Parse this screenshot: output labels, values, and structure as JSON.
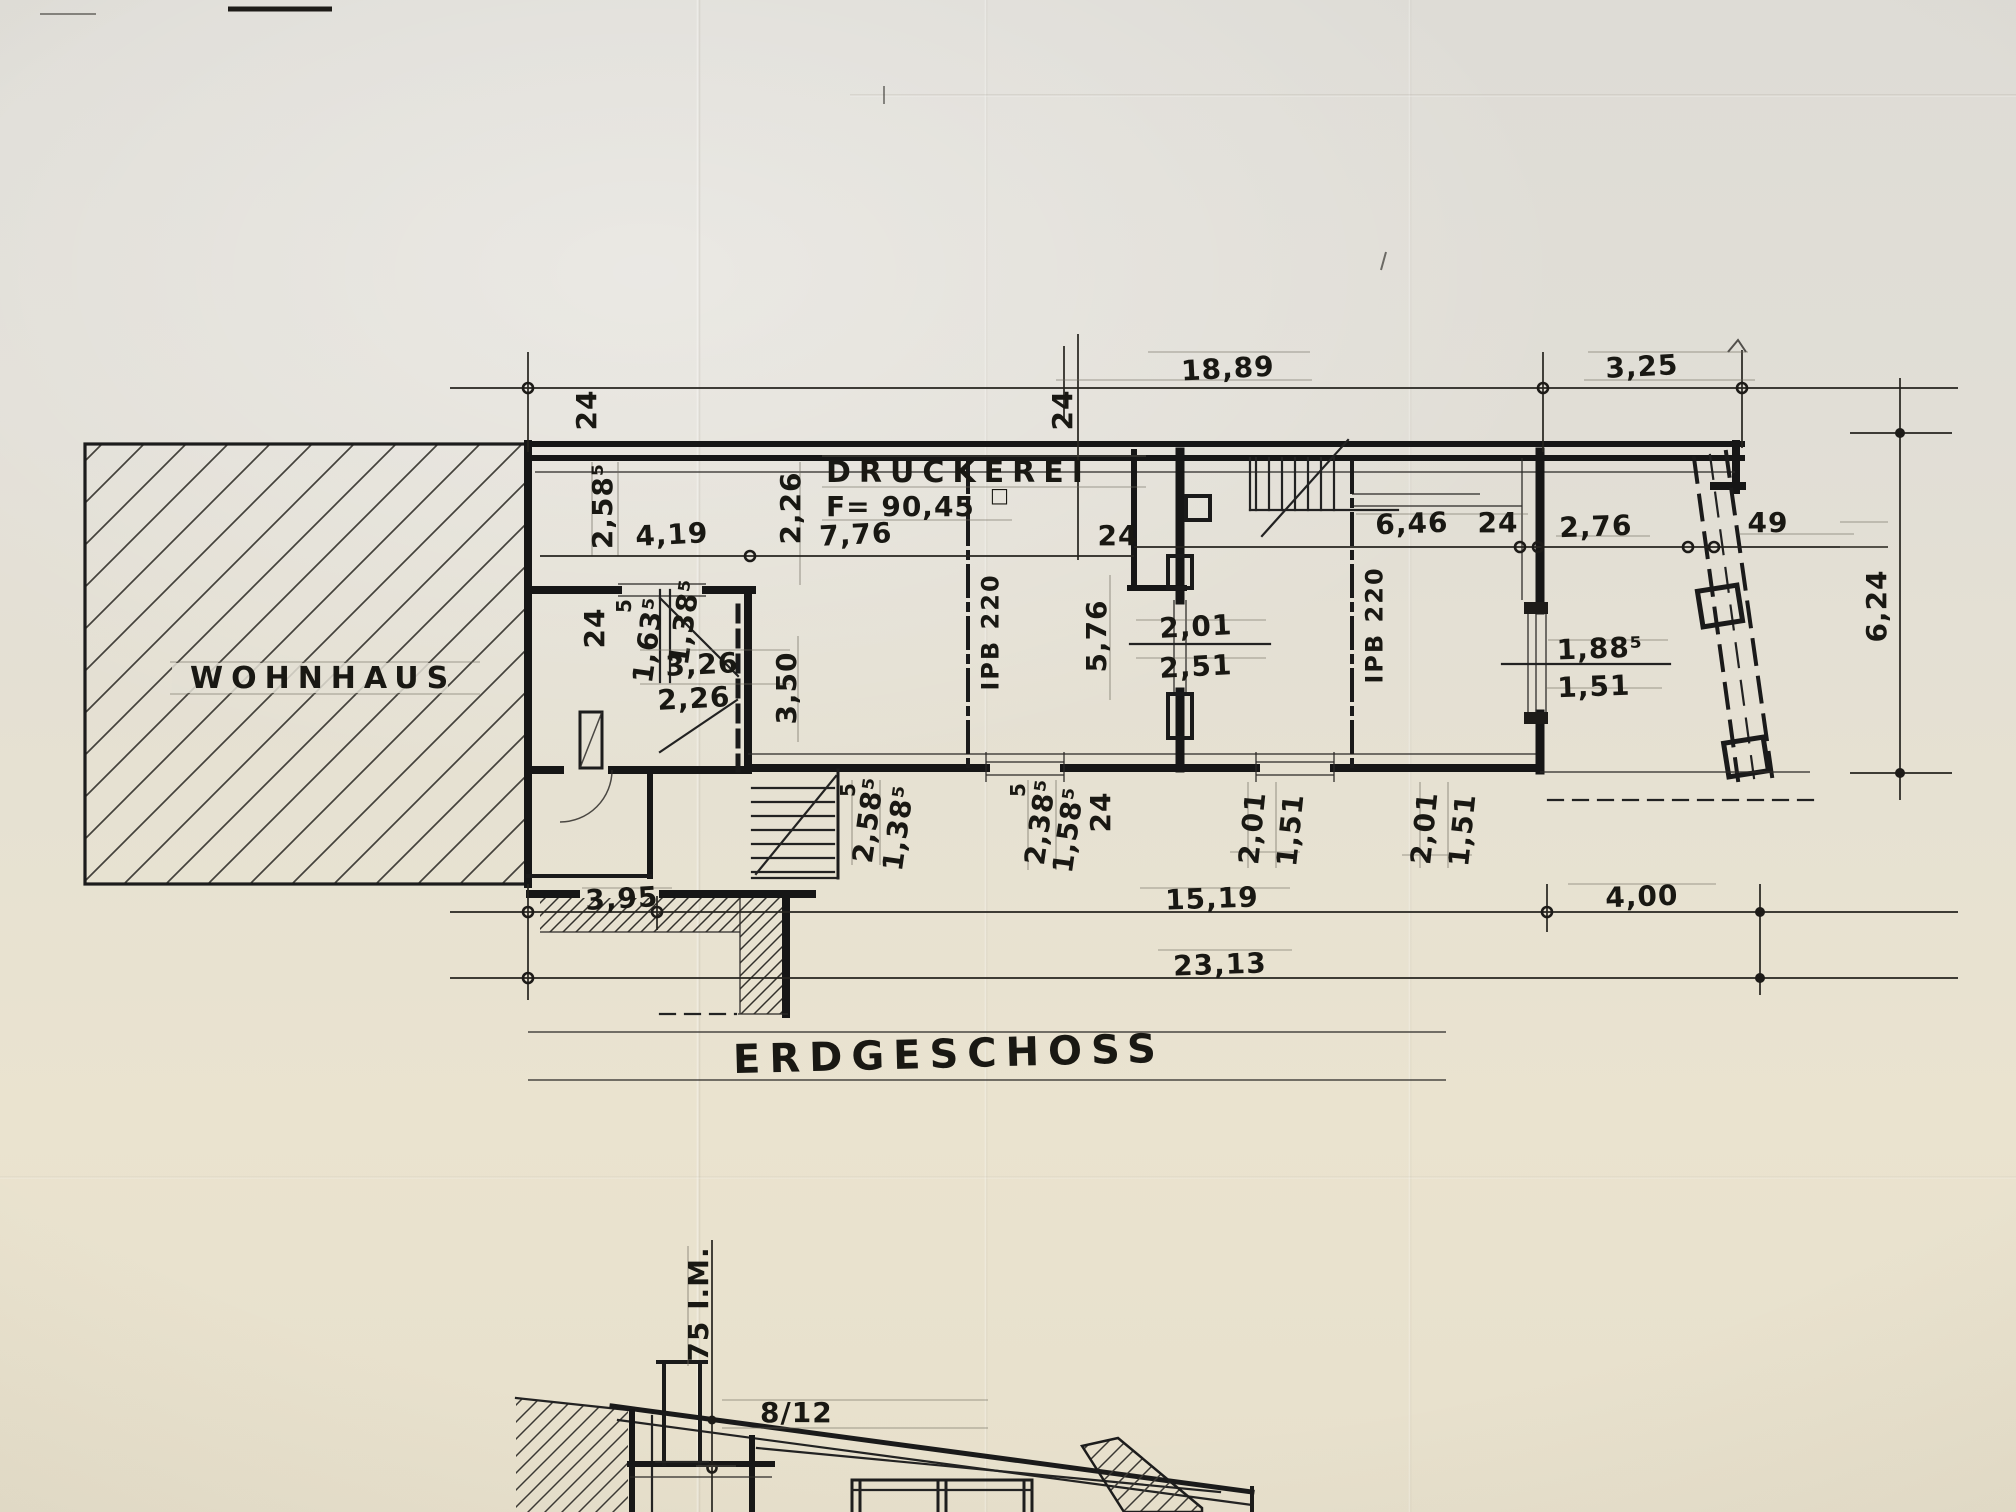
{
  "colors": {
    "paper": "#e6e1d3",
    "ink": "#1b1b1b"
  },
  "titles": {
    "sheet": "ERDGESCHOSS"
  },
  "rooms": {
    "wohnhaus": "WOHNHAUS",
    "druckerei": "DRUCKEREI",
    "druckerei_area": "F= 90,45",
    "druckerei_area_unit": "□"
  },
  "beams": {
    "left": "IPB 220",
    "right": "IPB 220"
  },
  "dims": {
    "top_main": "18,89",
    "top_right": "3,25",
    "top_wall": "24",
    "left_wall": "24",
    "left_height": "2,58⁵",
    "room1_width": "4,19",
    "room1_height": "2,26",
    "hall_width": "7,76",
    "mid_wall": "24",
    "right_width": "6,46",
    "right_wall": "24",
    "porch_width": "2,76",
    "porch_edge": "49",
    "side_height": "6,24",
    "wc_step": "5",
    "wc_a": "1,63⁵",
    "wc_b": "1,38⁵",
    "wc_width": "3,26",
    "wc_width_inner": "2,26",
    "wc_height": "3,50",
    "wc_wall": "24",
    "hall_height": "5,76",
    "door_mid_top": "2,01",
    "door_mid_bottom": "2,51",
    "window_top": "1,88⁵",
    "window_bottom": "1,51",
    "stair_step": "5",
    "stair_a": "2,58⁵",
    "stair_b": "1,38⁵",
    "exit_step": "5",
    "exit_a": "2,38⁵",
    "exit_b": "1,58⁵",
    "exit_wall": "24",
    "door2_top": "2,01",
    "door2_bottom": "1,51",
    "door3_top": "2,01",
    "door3_bottom": "1,51",
    "bottom_terrace": "3,95",
    "bottom_main": "15,19",
    "bottom_right": "4,00",
    "bottom_total": "23,13"
  },
  "section": {
    "chimney_height": "75 I.M.",
    "rafter": "8/12"
  }
}
